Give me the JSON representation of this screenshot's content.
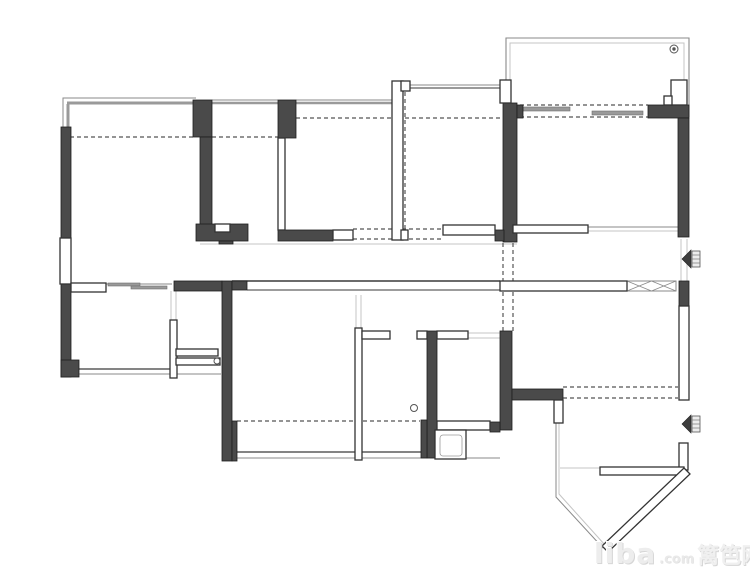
{
  "watermark": {
    "brand": "liba",
    "tld": ".com",
    "cjk": "篱笆网"
  },
  "plan": {
    "canvas": {
      "width": 750,
      "height": 578
    },
    "colors": {
      "wall_dark": "#4a4a4a",
      "wall_stroke": "#1f1f1f",
      "outline": "#333333",
      "line_dark": "#3a3a3a",
      "thin": "#8a8a8a",
      "light": "#c4c4c4",
      "band": "#9a9a9a",
      "dashed": "#555555",
      "panel": "#9a9a9a"
    },
    "polylines": [
      {
        "points": "506,80 506,38 689,38 689,117",
        "c": "thin",
        "w": 1.1,
        "n": "balcony-outer-outline"
      },
      {
        "points": "510,80 510,43 684,43 684,80",
        "c": "light",
        "w": 1,
        "n": "balcony-inner-outline"
      },
      {
        "points": "63,127 63,98 196,98",
        "c": "thin",
        "w": 1,
        "n": "top-left-outer-outline"
      },
      {
        "points": "556,423 556,497 603,548",
        "c": "thin",
        "w": 1,
        "n": "entry-bay-outer-line"
      },
      {
        "points": "559,423 559,494 605,545",
        "c": "light",
        "w": 1,
        "n": "entry-bay-inner-line"
      }
    ],
    "thin_lines": [
      {
        "x1": 67,
        "y1": 103,
        "x2": 196,
        "y2": 103,
        "w": 3,
        "c": "band"
      },
      {
        "x1": 68,
        "y1": 104,
        "x2": 68,
        "y2": 127,
        "w": 3,
        "c": "band"
      },
      {
        "x1": 212,
        "y1": 100,
        "x2": 278,
        "y2": 100,
        "w": 1,
        "c": "thin"
      },
      {
        "x1": 212,
        "y1": 103,
        "x2": 278,
        "y2": 103,
        "w": 2.5,
        "c": "band"
      },
      {
        "x1": 296,
        "y1": 100,
        "x2": 392,
        "y2": 100,
        "w": 1,
        "c": "thin"
      },
      {
        "x1": 296,
        "y1": 103,
        "x2": 392,
        "y2": 103,
        "w": 2.5,
        "c": "band"
      },
      {
        "x1": 410,
        "y1": 85,
        "x2": 503,
        "y2": 85,
        "w": 1,
        "c": "thin"
      },
      {
        "x1": 410,
        "y1": 88,
        "x2": 503,
        "y2": 88,
        "w": 2,
        "c": "band"
      },
      {
        "x1": 200,
        "y1": 244,
        "x2": 517,
        "y2": 244,
        "w": 1,
        "c": "light"
      },
      {
        "x1": 232,
        "y1": 281,
        "x2": 500,
        "y2": 281,
        "w": 1.5,
        "c": "line_dark"
      },
      {
        "x1": 247,
        "y1": 290,
        "x2": 500,
        "y2": 290,
        "w": 1,
        "c": "line_dark"
      },
      {
        "x1": 79,
        "y1": 369,
        "x2": 170,
        "y2": 369,
        "w": 1.2,
        "c": "line_dark"
      },
      {
        "x1": 79,
        "y1": 374,
        "x2": 170,
        "y2": 374,
        "w": 1,
        "c": "thin"
      },
      {
        "x1": 176,
        "y1": 374,
        "x2": 221,
        "y2": 374,
        "w": 1,
        "c": "thin"
      },
      {
        "x1": 237,
        "y1": 452,
        "x2": 428,
        "y2": 452,
        "w": 1.2,
        "c": "line_dark"
      },
      {
        "x1": 237,
        "y1": 458,
        "x2": 500,
        "y2": 458,
        "w": 1,
        "c": "thin"
      },
      {
        "x1": 588,
        "y1": 227,
        "x2": 679,
        "y2": 227,
        "w": 1,
        "c": "thin"
      },
      {
        "x1": 588,
        "y1": 231,
        "x2": 679,
        "y2": 231,
        "w": 1,
        "c": "light"
      },
      {
        "x1": 681,
        "y1": 239,
        "x2": 681,
        "y2": 281,
        "w": 1,
        "c": "light"
      },
      {
        "x1": 687,
        "y1": 239,
        "x2": 687,
        "y2": 281,
        "w": 1,
        "c": "light"
      },
      {
        "x1": 468,
        "y1": 333,
        "x2": 500,
        "y2": 333,
        "w": 1,
        "c": "light"
      },
      {
        "x1": 468,
        "y1": 338,
        "x2": 500,
        "y2": 338,
        "w": 1,
        "c": "light"
      },
      {
        "x1": 106,
        "y1": 284,
        "x2": 172,
        "y2": 284,
        "w": 1,
        "c": "thin"
      },
      {
        "x1": 171,
        "y1": 291,
        "x2": 171,
        "y2": 320,
        "w": 1,
        "c": "light"
      },
      {
        "x1": 176,
        "y1": 291,
        "x2": 176,
        "y2": 320,
        "w": 1,
        "c": "light"
      },
      {
        "x1": 356,
        "y1": 295,
        "x2": 356,
        "y2": 328,
        "w": 1,
        "c": "light"
      },
      {
        "x1": 361,
        "y1": 295,
        "x2": 361,
        "y2": 328,
        "w": 1,
        "c": "light"
      },
      {
        "x1": 560,
        "y1": 468,
        "x2": 600,
        "y2": 468,
        "w": 1,
        "c": "light"
      }
    ],
    "dashed_lines": [
      {
        "x1": 70,
        "y1": 137,
        "x2": 193,
        "y2": 137
      },
      {
        "x1": 212,
        "y1": 137,
        "x2": 278,
        "y2": 137
      },
      {
        "x1": 296,
        "y1": 118,
        "x2": 392,
        "y2": 118
      },
      {
        "x1": 405,
        "y1": 118,
        "x2": 503,
        "y2": 118
      },
      {
        "x1": 405,
        "y1": 92,
        "x2": 405,
        "y2": 230
      },
      {
        "x1": 353,
        "y1": 229,
        "x2": 495,
        "y2": 229
      },
      {
        "x1": 353,
        "y1": 239,
        "x2": 443,
        "y2": 239
      },
      {
        "x1": 503,
        "y1": 243,
        "x2": 503,
        "y2": 331
      },
      {
        "x1": 513,
        "y1": 243,
        "x2": 513,
        "y2": 331
      },
      {
        "x1": 520,
        "y1": 105,
        "x2": 648,
        "y2": 105
      },
      {
        "x1": 520,
        "y1": 117,
        "x2": 648,
        "y2": 117
      },
      {
        "x1": 563,
        "y1": 387,
        "x2": 678,
        "y2": 387
      },
      {
        "x1": 563,
        "y1": 398,
        "x2": 678,
        "y2": 398
      },
      {
        "x1": 237,
        "y1": 421,
        "x2": 420,
        "y2": 421
      }
    ],
    "panels": [
      {
        "x": 523,
        "y": 107,
        "w": 47,
        "h": 4
      },
      {
        "x": 592,
        "y": 111,
        "w": 51,
        "h": 4
      },
      {
        "x": 108,
        "y": 283,
        "w": 32,
        "h": 3
      },
      {
        "x": 131,
        "y": 286,
        "w": 36,
        "h": 3
      }
    ],
    "xboxes": [
      {
        "x": 627,
        "y": 281,
        "w": 49,
        "h": 10
      }
    ],
    "dark_walls": [
      {
        "x": 61,
        "y": 127,
        "w": 10,
        "h": 113,
        "n": "exterior-wall-left-upper"
      },
      {
        "x": 61,
        "y": 283,
        "w": 10,
        "h": 94,
        "n": "exterior-wall-left-lower"
      },
      {
        "x": 61,
        "y": 360,
        "w": 18,
        "h": 17
      },
      {
        "x": 193,
        "y": 100,
        "w": 19,
        "h": 37
      },
      {
        "x": 200,
        "y": 137,
        "w": 12,
        "h": 93
      },
      {
        "x": 196,
        "y": 224,
        "w": 52,
        "h": 17
      },
      {
        "x": 219,
        "y": 241,
        "w": 14,
        "h": 3
      },
      {
        "x": 278,
        "y": 100,
        "w": 18,
        "h": 38
      },
      {
        "x": 278,
        "y": 230,
        "w": 55,
        "h": 11
      },
      {
        "x": 503,
        "y": 103,
        "w": 14,
        "h": 139
      },
      {
        "x": 517,
        "y": 105,
        "w": 6,
        "h": 13
      },
      {
        "x": 495,
        "y": 230,
        "w": 9,
        "h": 11
      },
      {
        "x": 648,
        "y": 105,
        "w": 41,
        "h": 13,
        "n": "balcony-right-wall"
      },
      {
        "x": 678,
        "y": 118,
        "w": 11,
        "h": 119,
        "n": "exterior-wall-right"
      },
      {
        "x": 174,
        "y": 281,
        "w": 48,
        "h": 10
      },
      {
        "x": 222,
        "y": 281,
        "w": 10,
        "h": 180
      },
      {
        "x": 232,
        "y": 281,
        "w": 15,
        "h": 9
      },
      {
        "x": 232,
        "y": 421,
        "w": 5,
        "h": 40
      },
      {
        "x": 427,
        "y": 331,
        "w": 10,
        "h": 127
      },
      {
        "x": 421,
        "y": 420,
        "w": 6,
        "h": 38
      },
      {
        "x": 500,
        "y": 331,
        "w": 12,
        "h": 99
      },
      {
        "x": 512,
        "y": 389,
        "w": 51,
        "h": 11
      },
      {
        "x": 490,
        "y": 422,
        "w": 10,
        "h": 10
      },
      {
        "x": 679,
        "y": 281,
        "w": 10,
        "h": 25
      }
    ],
    "white_walls": [
      {
        "x": 60,
        "y": 238,
        "w": 11,
        "h": 46,
        "n": "window-left"
      },
      {
        "x": 71,
        "y": 283,
        "w": 35,
        "h": 9
      },
      {
        "x": 392,
        "y": 81,
        "w": 11,
        "h": 159
      },
      {
        "x": 401,
        "y": 81,
        "w": 9,
        "h": 10
      },
      {
        "x": 401,
        "y": 230,
        "w": 7,
        "h": 10
      },
      {
        "x": 500,
        "y": 80,
        "w": 11,
        "h": 23
      },
      {
        "x": 671,
        "y": 80,
        "w": 16,
        "h": 25
      },
      {
        "x": 664,
        "y": 96,
        "w": 8,
        "h": 9
      },
      {
        "x": 170,
        "y": 320,
        "w": 7,
        "h": 58
      },
      {
        "x": 176,
        "y": 349,
        "w": 42,
        "h": 7
      },
      {
        "x": 176,
        "y": 358,
        "w": 44,
        "h": 7
      },
      {
        "x": 443,
        "y": 225,
        "w": 52,
        "h": 10
      },
      {
        "x": 513,
        "y": 225,
        "w": 75,
        "h": 8,
        "n": "kitchen-counter-wall"
      },
      {
        "x": 500,
        "y": 281,
        "w": 127,
        "h": 10
      },
      {
        "x": 355,
        "y": 328,
        "w": 7,
        "h": 132
      },
      {
        "x": 362,
        "y": 331,
        "w": 28,
        "h": 8
      },
      {
        "x": 417,
        "y": 331,
        "w": 10,
        "h": 8
      },
      {
        "x": 437,
        "y": 331,
        "w": 31,
        "h": 8
      },
      {
        "x": 437,
        "y": 421,
        "w": 53,
        "h": 9
      },
      {
        "x": 435,
        "y": 430,
        "w": 31,
        "h": 29,
        "n": "fixture-box"
      },
      {
        "x": 440,
        "y": 435,
        "w": 22,
        "h": 21,
        "light": true,
        "rx": 3,
        "n": "fixture-box-inner"
      },
      {
        "x": 554,
        "y": 400,
        "w": 9,
        "h": 23
      },
      {
        "x": 679,
        "y": 306,
        "w": 10,
        "h": 94
      },
      {
        "x": 679,
        "y": 443,
        "w": 9,
        "h": 27
      },
      {
        "x": 600,
        "y": 467,
        "w": 84,
        "h": 8
      },
      {
        "x": 215,
        "y": 224,
        "w": 15,
        "h": 8
      },
      {
        "x": 333,
        "y": 230,
        "w": 20,
        "h": 10
      },
      {
        "x": 278,
        "y": 138,
        "w": 7,
        "h": 92
      }
    ],
    "polygons": [
      {
        "points": "684,468 690,474 608,552 602,546",
        "n": "wall-diagonal-bay"
      }
    ],
    "circles": [
      {
        "cx": 674,
        "cy": 49,
        "r": 4
      },
      {
        "cx": 674,
        "cy": 49,
        "r": 1.2,
        "fill": true
      },
      {
        "cx": 414,
        "cy": 408,
        "r": 3.5
      },
      {
        "cx": 217,
        "cy": 361,
        "r": 3
      }
    ],
    "door_markers": [
      {
        "x": 691,
        "y": 250
      },
      {
        "x": 691,
        "y": 415
      }
    ]
  }
}
